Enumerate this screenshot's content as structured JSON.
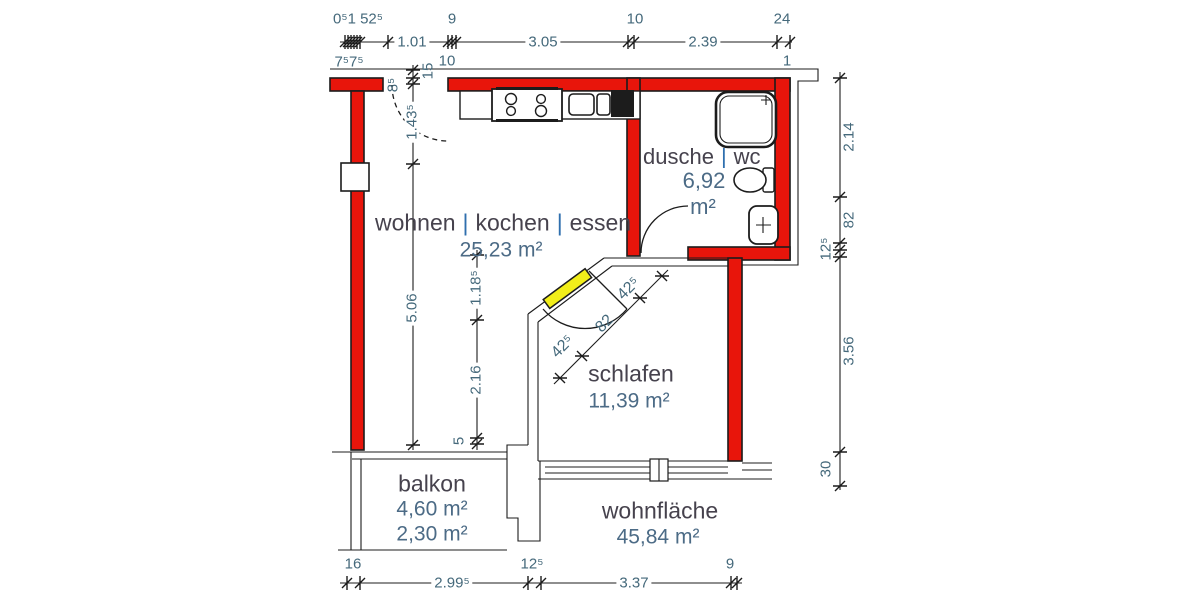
{
  "drawing": {
    "rooms": {
      "wohnen": {
        "part1": "wohnen",
        "part2": "kochen",
        "part3": "essen",
        "sep": "|",
        "area": "25,23 m²"
      },
      "dusche": {
        "part1": "dusche",
        "part2": "wc",
        "sep": "|",
        "area": "6,92",
        "unit": "m²"
      },
      "schlafen": {
        "name": "schlafen",
        "area": "11,39 m²"
      },
      "balkon": {
        "name": "balkon",
        "area_total": "4,60 m²",
        "area_counted": "2,30 m²"
      },
      "wohnflaeche": {
        "name": "wohnfläche",
        "area": "45,84 m²"
      }
    },
    "dims": {
      "top": {
        "cluster": "0⁵1 52⁵",
        "w9": "9",
        "w10": "10",
        "w24": "24",
        "s1": "1.01",
        "s2": "3.05",
        "s3": "2.39",
        "sub_left": "7⁵7⁵",
        "sub_10": "10",
        "sub_1": "1",
        "jamb": "8⁵",
        "wall15": "15"
      },
      "left": {
        "s1": "1.43⁵",
        "s2": "5.06"
      },
      "mid": {
        "s1": "1.18⁵",
        "s2": "2.16",
        "s3": "5"
      },
      "door": {
        "s1": "42⁵",
        "s2": "82",
        "s3": "42⁵"
      },
      "right": {
        "s1": "2.14",
        "s2": "82",
        "s3": "12⁵",
        "s4": "3.56",
        "s5": "30"
      },
      "bottom": {
        "t16": "16",
        "s1": "2.99⁵",
        "t125": "12⁵",
        "s2": "3.37",
        "t9": "9"
      }
    },
    "colors": {
      "wall": "#e8150b",
      "door_highlight": "#f2ee1a",
      "line": "#1c1c1c",
      "dim_text": "#45697b",
      "area_text": "#4c6b86",
      "room_text": "#46424d",
      "pipe": "#2f6fae"
    }
  }
}
